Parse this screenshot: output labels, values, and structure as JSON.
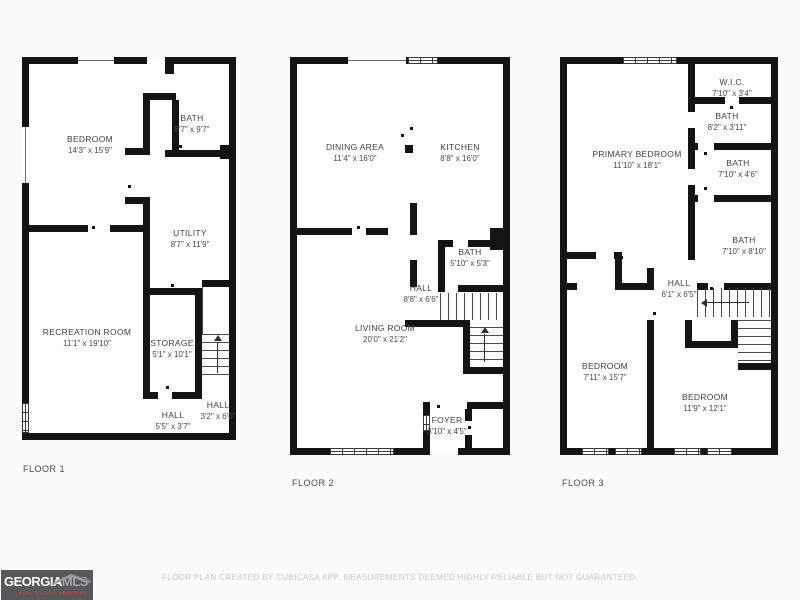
{
  "floors": [
    {
      "label": "FLOOR 1",
      "rooms": [
        {
          "name": "BEDROOM",
          "dims": "14'3\" x 15'9\""
        },
        {
          "name": "BATH",
          "dims": "8'7\" x 9'7\""
        },
        {
          "name": "UTILITY",
          "dims": "8'7\" x 11'9\""
        },
        {
          "name": "RECREATION ROOM",
          "dims": "11'1\" x 19'10\""
        },
        {
          "name": "STORAGE",
          "dims": "5'1\" x 10'1\""
        },
        {
          "name": "HALL",
          "dims": "5'5\" x 3'7\""
        },
        {
          "name": "HALL",
          "dims": "3'2\" x 6'0\""
        }
      ]
    },
    {
      "label": "FLOOR 2",
      "rooms": [
        {
          "name": "DINING AREA",
          "dims": "11'4\" x 16'0\""
        },
        {
          "name": "KITCHEN",
          "dims": "8'8\" x 16'0\""
        },
        {
          "name": "BATH",
          "dims": "5'10\" x 5'3\""
        },
        {
          "name": "HALL",
          "dims": "8'8\" x 6'6\""
        },
        {
          "name": "LIVING ROOM",
          "dims": "20'0\" x 21'2\""
        },
        {
          "name": "FOYER",
          "dims": "3'10\" x 4'5\""
        }
      ]
    },
    {
      "label": "FLOOR 3",
      "rooms": [
        {
          "name": "PRIMARY BEDROOM",
          "dims": "11'10\" x 18'1\""
        },
        {
          "name": "W.I.C.",
          "dims": "7'10\" x 3'4\""
        },
        {
          "name": "BATH",
          "dims": "8'2\" x 3'11\""
        },
        {
          "name": "BATH",
          "dims": "7'10\" x 4'6\""
        },
        {
          "name": "BATH",
          "dims": "7'10\" x 8'10\""
        },
        {
          "name": "HALL",
          "dims": "6'1\" x 6'5\""
        },
        {
          "name": "BEDROOM",
          "dims": "7'11\" x 15'7\""
        },
        {
          "name": "BEDROOM",
          "dims": "11'9\" x 12'1\""
        }
      ]
    }
  ],
  "footer": {
    "logo": {
      "brand_primary": "GEORGIA",
      "brand_secondary": "MLS",
      "tagline": "REAL ESTATE SERVICES"
    },
    "disclaimer": "FLOOR PLAN CREATED BY CUBICASA APP. MEASUREMENTS DEEMED HIGHLY RELIABLE BUT NOT GUARANTEED."
  },
  "colors": {
    "wall": "#141414",
    "label_text": "#424242",
    "floor_label_text": "#4a4a4a",
    "logo_bg": "#58585a",
    "logo_mls": "#a4a6a9",
    "logo_tagline": "#bf4a4a",
    "disclaimer_text": "#c7c7c7",
    "background": "#fbfbfb"
  }
}
